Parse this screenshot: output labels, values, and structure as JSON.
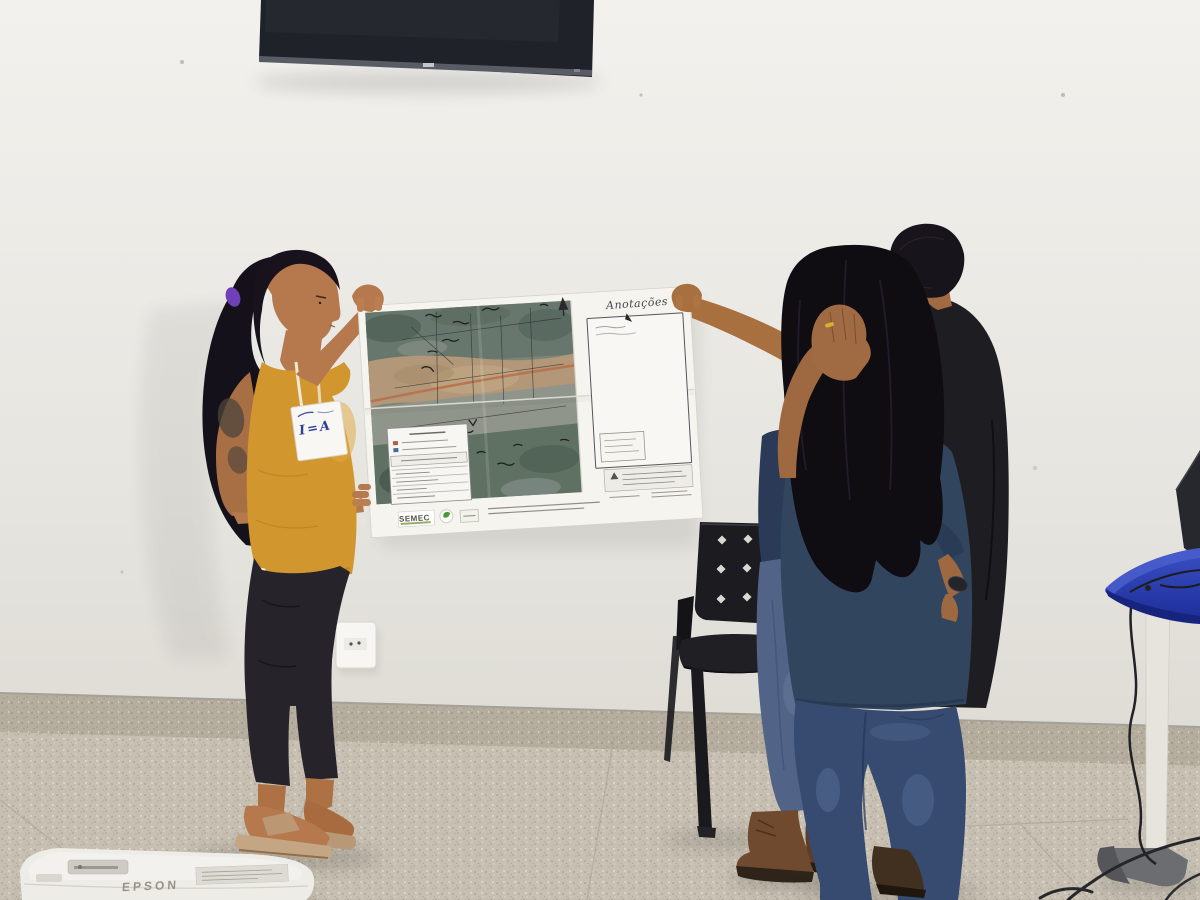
{
  "scene": {
    "type": "photograph",
    "description": "Four people in a white-walled room hold up a large printed satellite map poster; a wall-mounted TV above, a black perforated chair, a blue side table with a laptop, and a projector on the terrazzo floor.",
    "colors": {
      "wall": "#e9e7e2",
      "floor": "#c7c0b2",
      "tv_screen": "#202229",
      "map_paper": "#f5f4ef",
      "yellow_top": "#d2962f",
      "navy_tshirt": "#32455f",
      "jeans": "#374b70",
      "black_tshirt": "#1e1e22",
      "chair": "#1c1c20",
      "table_blue": "#2a3db2",
      "projector_body": "#edece7"
    }
  },
  "poster": {
    "annotations_title": "Anotações",
    "publisher_label": "SEMEC",
    "content": "satellite map with handwritten field notes, legend box and footer logos"
  },
  "badge": {
    "text": "I=A"
  },
  "projector": {
    "brand": "EPSON"
  }
}
